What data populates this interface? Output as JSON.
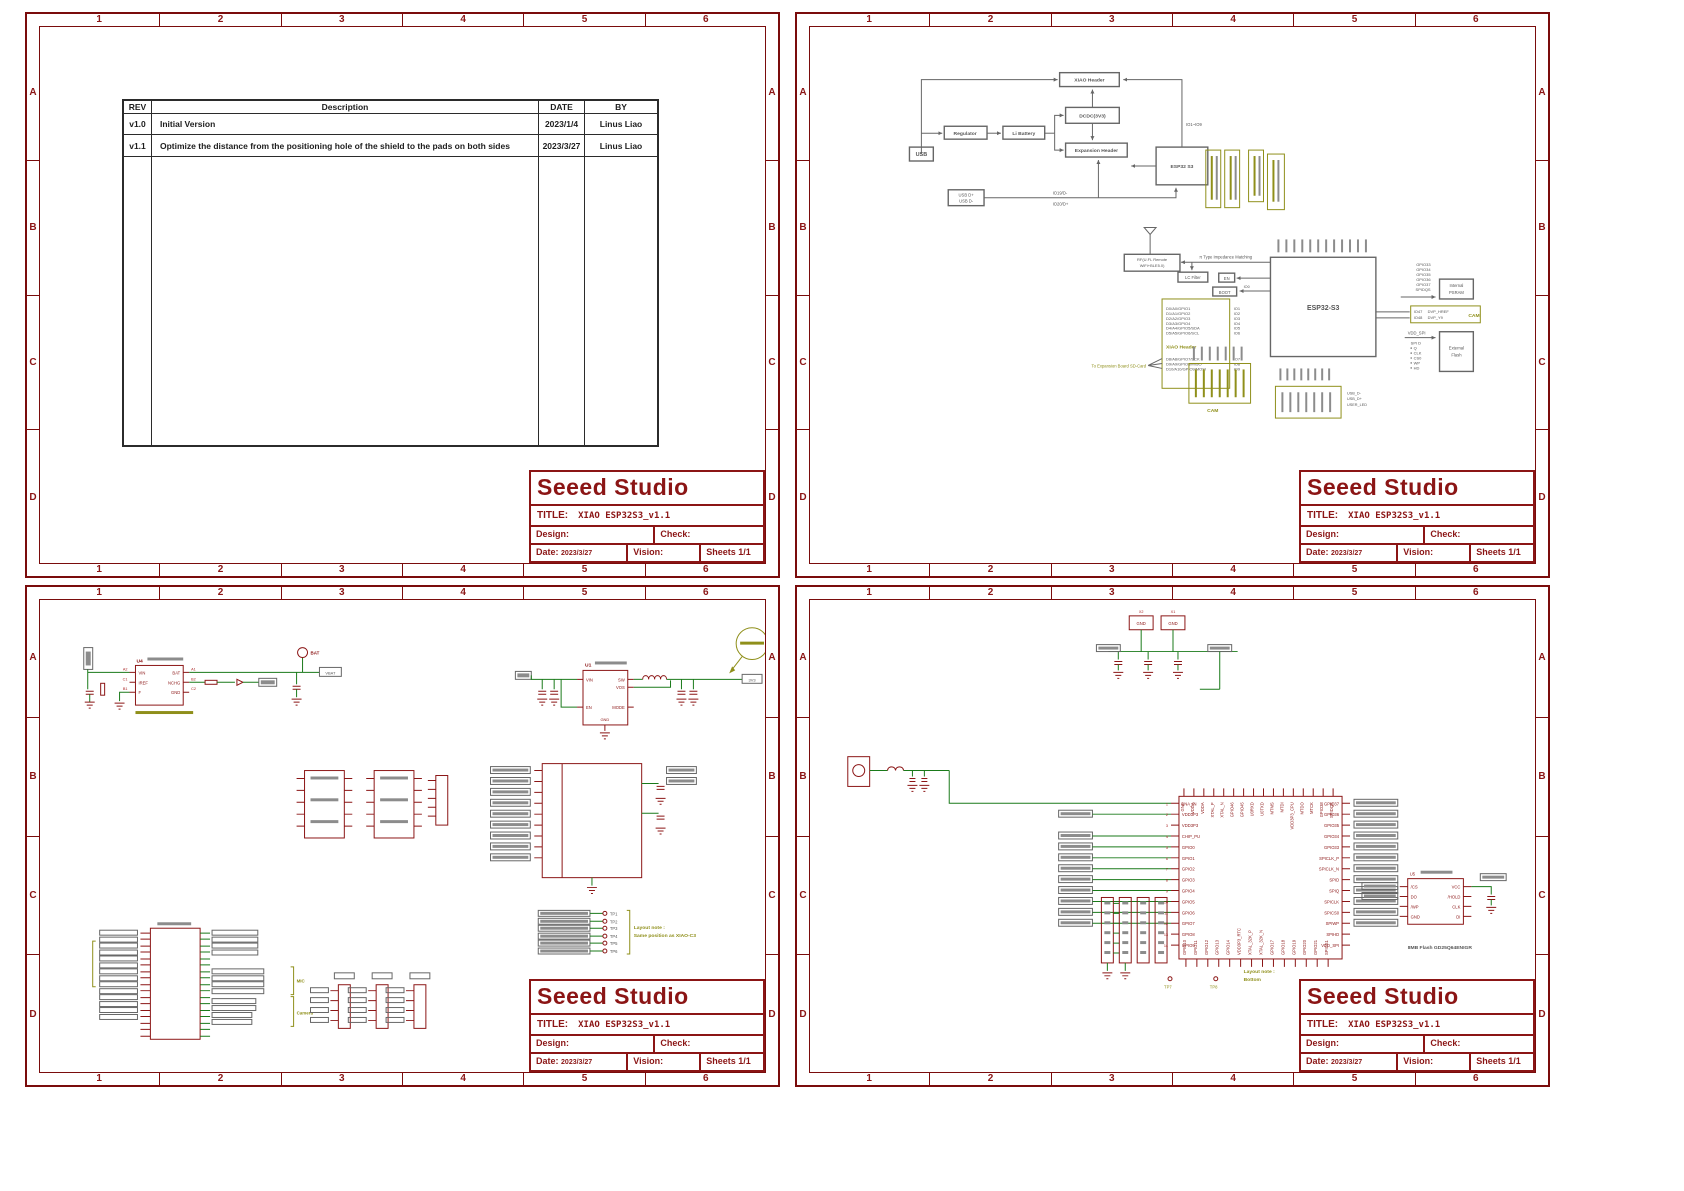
{
  "frame": {
    "cols": [
      "1",
      "2",
      "3",
      "4",
      "5",
      "6"
    ],
    "rows": [
      "A",
      "B",
      "C",
      "D"
    ]
  },
  "titleblock": {
    "brand": "Seeed Studio",
    "title_label": "TITLE:",
    "title": "XIAO ESP32S3_v1.1",
    "design": "Design:",
    "check": "Check:",
    "date": "Date:",
    "date_value": "2023/3/27",
    "vision": "Vision:",
    "sheets": "Sheets 1/1"
  },
  "rev_table": {
    "headers": [
      "REV",
      "Description",
      "DATE",
      "BY"
    ],
    "rows": [
      [
        "v1.0",
        "Initial Version",
        "2023/1/4",
        "Linus Liao"
      ],
      [
        "v1.1",
        "Optimize the distance from the positioning hole of the shield to the pads on both sides",
        "2023/3/27",
        "Linus Liao"
      ]
    ]
  },
  "p2": {
    "bd": {
      "usb": "USB",
      "regulator": "Regulator",
      "li_battery": "Li Battery",
      "dcdc": "DCDC(3V3)",
      "xiao_header": "XIAO Header",
      "expansion_header": "Expansion Header",
      "esp32": "ESP32 S3",
      "usb_dp": "USB D+",
      "usb_dm": "USB D-",
      "io_range": "IO1~IO9",
      "io19": "IO19/D-",
      "io20": "IO20/D+"
    },
    "rf": {
      "ant1": "RF(U.FL Remote",
      "ant2": "WiFi+BLE5.0)",
      "matching": "π Type Impedance Matching",
      "lc": "LC Filter",
      "en": "EN",
      "boot": "BOOT",
      "io0": "IO0",
      "chip": "ESP32-S3"
    },
    "xiao": {
      "label": "XIAO Header",
      "note": "To Expansion Board SD-Card",
      "sig1": [
        "D0/A0/GPIO1",
        "D1/A1/GPIO2",
        "D2/A2/GPIO3",
        "D3/A3/GPIO4",
        "D4/A4/GPIO5/SDA",
        "D5/A5/GPIO6/SCL"
      ],
      "io1": [
        "IO1",
        "IO2",
        "IO3",
        "IO4",
        "IO5",
        "IO6"
      ],
      "sig2": [
        "D8/A8/GPIO7/SCK",
        "D9/A9/GPIO8/MISO",
        "D10/A10/GPIO9/MOSI"
      ],
      "io2": [
        "IO7",
        "IO8",
        "IO9"
      ]
    },
    "psram": {
      "nets": [
        "GPIO33",
        "GPIO34",
        "GPIO35",
        "GPIO36",
        "GPIO37",
        "SPIDQS"
      ],
      "box1": "Internal",
      "box2": "PSRAM"
    },
    "cam": {
      "ios": [
        "IO47",
        "IO48"
      ],
      "sigs": [
        "DVP_HREF",
        "DVP_Y9"
      ],
      "tag": "CAM"
    },
    "flash": {
      "vdd": "VDD_SPI",
      "list": [
        "SPI D",
        "Q",
        "CLK",
        "CS0",
        "WP",
        "HD"
      ],
      "box1": "External",
      "box2": "Flash"
    },
    "usb_net": [
      "USB_D-",
      "USB_D+",
      "USER_LED"
    ]
  },
  "p3": {
    "u4": {
      "ref": "U4",
      "l": [
        "VIN",
        "IREF",
        "F"
      ],
      "r": [
        "BAT",
        "NCHG",
        "GND"
      ],
      "pl": [
        "A2",
        "C1",
        "B1"
      ],
      "pr": [
        "A1",
        "B2",
        "C2"
      ],
      "bat": "BAT",
      "vbat": "VBAT"
    },
    "u1": {
      "ref": "U1",
      "l": [
        "VIN",
        "EN"
      ],
      "r": [
        "SW",
        "VOS",
        "MODE"
      ],
      "gnd": "GND",
      "out": "3V3"
    },
    "tps": [
      "TP1",
      "TP2",
      "TP3",
      "TP4",
      "TP5",
      "TP6"
    ],
    "note1": "Layout note :",
    "note2": "Same position as XIAO-C3",
    "mic": "MIC",
    "camera": "Camera"
  },
  "p4": {
    "chip_left": [
      "LNA_IN",
      "VDD3P3",
      "VDD3P3",
      "CHIP_PU",
      "GPIO0",
      "GPIO1",
      "GPIO2",
      "GPIO3",
      "GPIO4",
      "GPIO5",
      "GPIO6",
      "GPIO7",
      "GPIO8",
      "GPIO9"
    ],
    "chip_left_nums": [
      "1",
      "2",
      "3",
      "4",
      "5",
      "6",
      "7",
      "8",
      "9",
      "10",
      "11",
      "12",
      "13",
      "14"
    ],
    "chip_bottom": [
      "GPIO10",
      "GPIO11",
      "GPIO12",
      "GPIO13",
      "GPIO14",
      "VDD3P3_RTC",
      "XTAL_32K_P",
      "XTAL_32K_N",
      "GPIO17",
      "GPIO18",
      "GPIO19",
      "GPIO20",
      "GPIO21",
      "SPICS1"
    ],
    "chip_right": [
      "GPIO37",
      "GPIO36",
      "GPIO35",
      "GPIO34",
      "GPIO33",
      "SPICLK_P",
      "SPICLK_N",
      "SPID",
      "SPIQ",
      "SPICLK",
      "SPICS0",
      "SPIWP",
      "SPIHD",
      "VDD_SPI"
    ],
    "chip_top": [
      "GND",
      "VDDA",
      "VDDA",
      "XTAL_P",
      "XTAL_N",
      "GPIO46",
      "GPIO45",
      "U0RXD",
      "U0TXD",
      "MTMS",
      "MTDI",
      "VDD3P3_CPU",
      "MTDO",
      "MTCK",
      "GPIO38",
      "SPIDQS"
    ],
    "u5": {
      "ref": "U5",
      "l": [
        "/CS",
        "DO",
        "/WP",
        "GND"
      ],
      "r": [
        "VCC",
        "/HOLD",
        "CLK",
        "DI"
      ]
    },
    "flash_caption": "8MB Flash  GD25Q64ENIGR",
    "note1": "Layout note :",
    "note2": "Bottom",
    "tp7": "TP7",
    "tp8": "TP8",
    "pads": [
      "GND",
      "GND"
    ],
    "pad_refs": [
      "X2",
      "X1"
    ]
  }
}
